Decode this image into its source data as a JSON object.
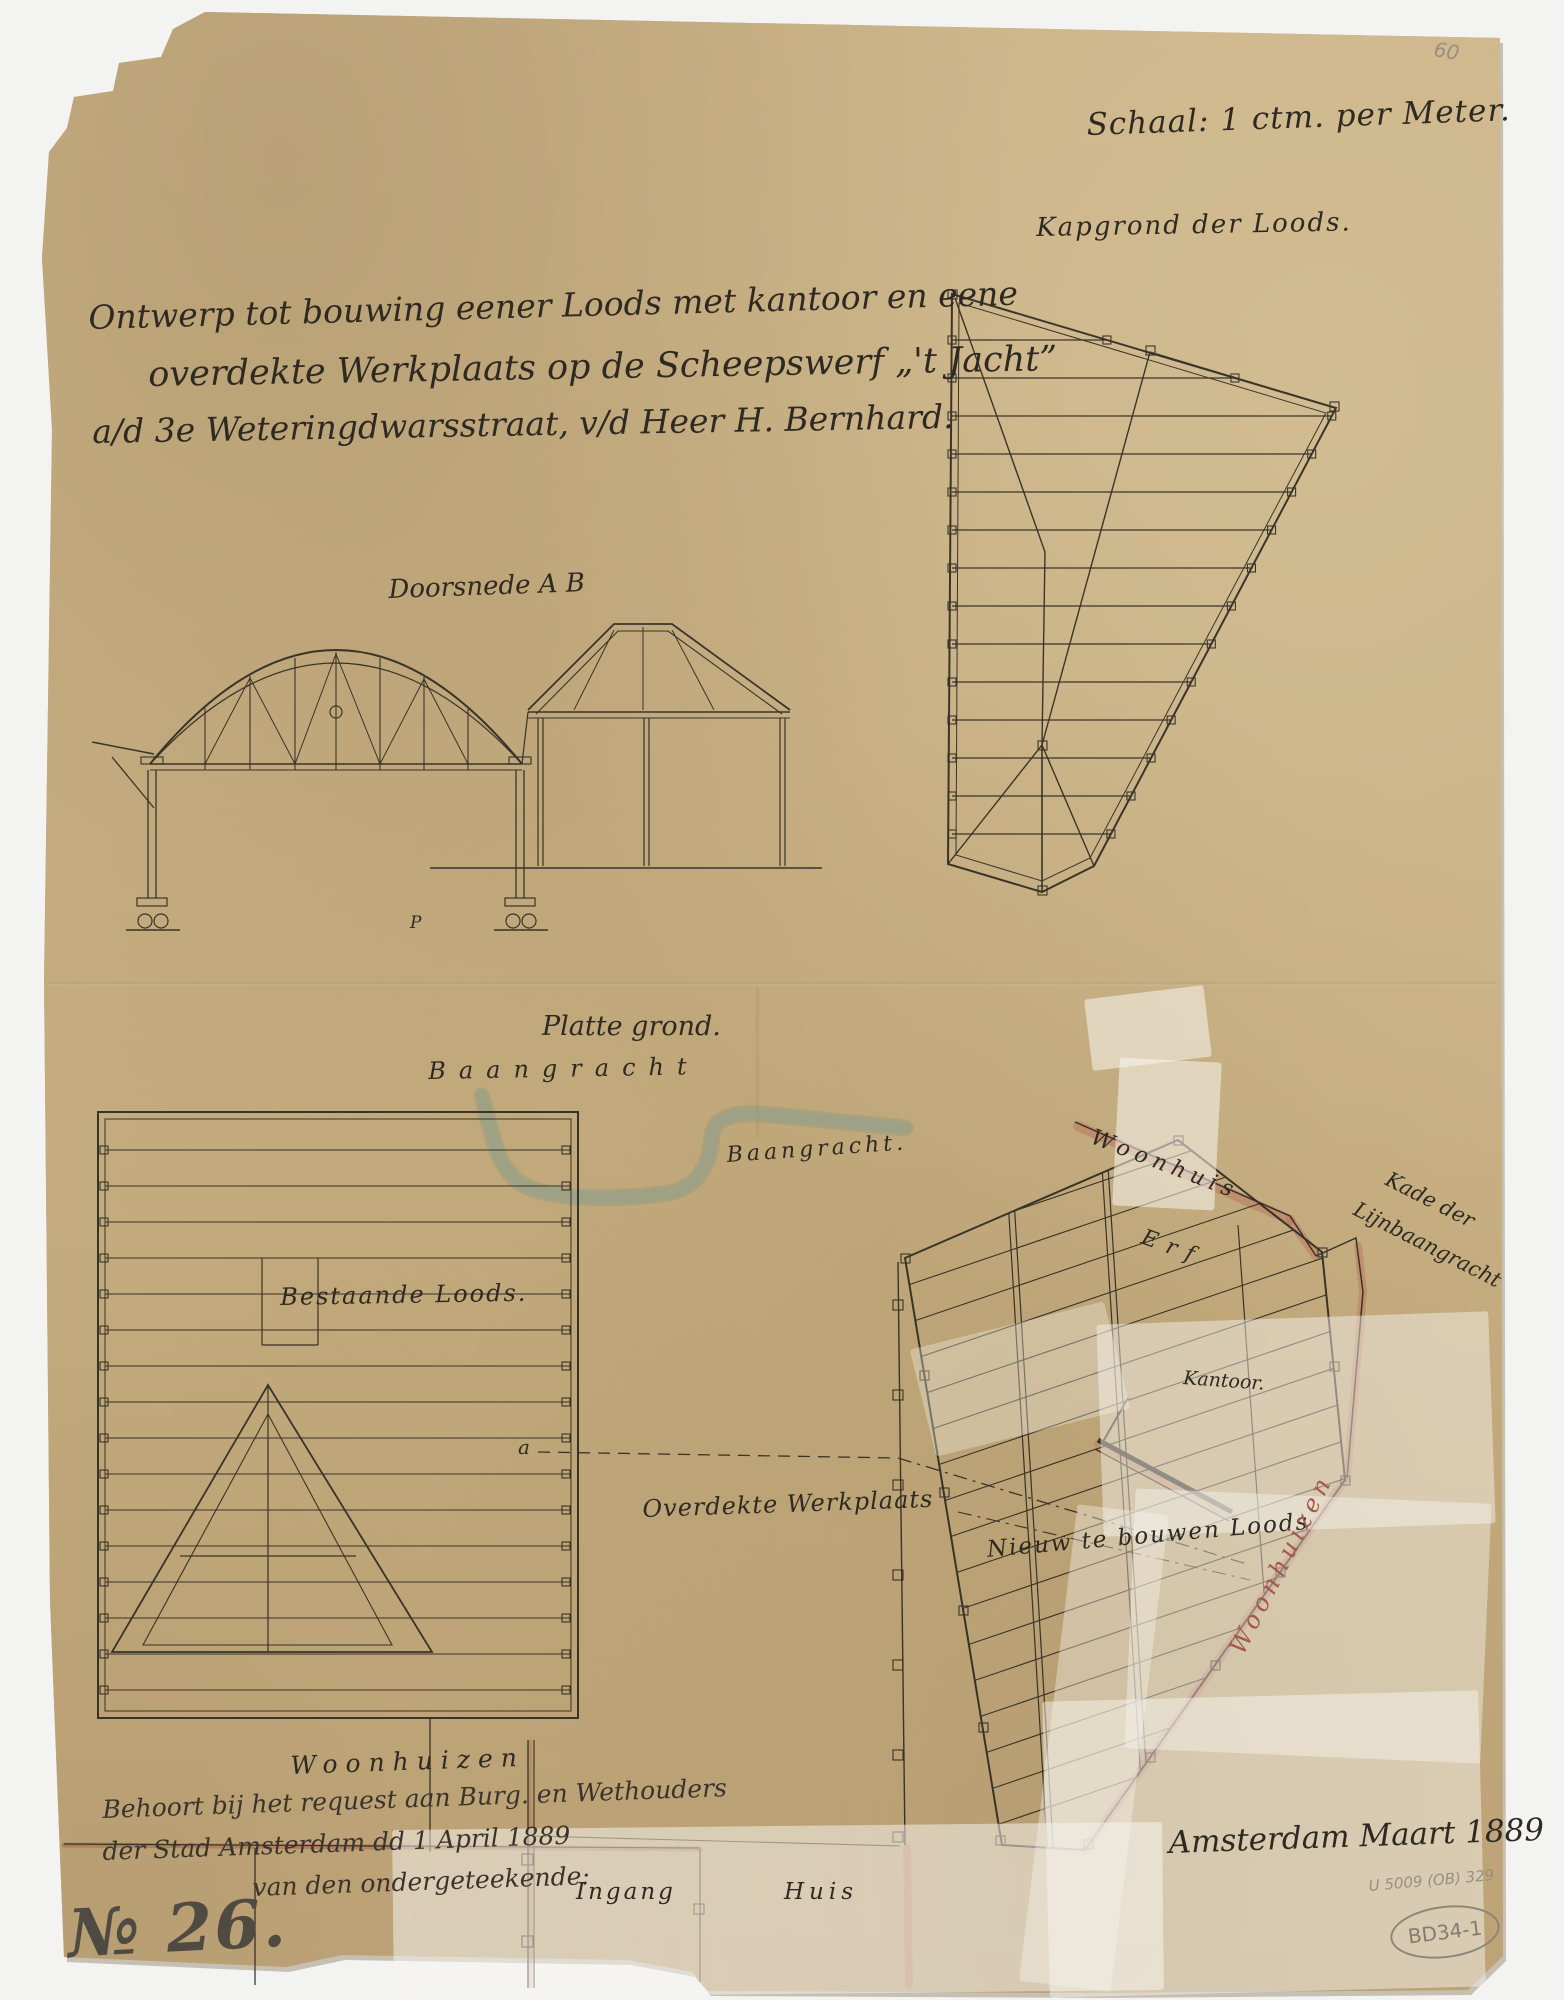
{
  "document": {
    "scale_note": "Schaal: 1 ctm. per Meter.",
    "corner_mark": "60",
    "title_lines": [
      "Ontwerp tot bouwing eener Loods met kantoor en eene",
      "overdekte Werkplaats op de Scheepswerf „'t Jacht”",
      "a/d 3e Weteringdwarsstraat, v/d Heer  H.  Bernhard."
    ],
    "roof_plan": {
      "label": "Kapgrond der Loods."
    },
    "section": {
      "label": "Doorsnede A B",
      "point_mark": "P"
    },
    "site_plan": {
      "label": "Platte grond.",
      "street": "Baangracht",
      "canal": "Baangracht.",
      "existing_shed": "Bestaande Loods.",
      "covered_workshop": "Overdekte Werkplaats",
      "house": "Woonhuis",
      "yard": "Erf",
      "quay_line1": "Kade der",
      "quay_line2": "Lijnbaangracht",
      "office": "Kantoor.",
      "new_shed": "Nieuw te bouwen Loods",
      "houses_right": "Woonhuizen",
      "houses_bottom": "Woonhuizen",
      "entrance": "Ingang",
      "house_small": "Huis",
      "section_mark": "a"
    },
    "annotation_lines": [
      "Behoort bij het request aan Burg. en Wethouders",
      "der Stad Amsterdam dd 1 April 1889",
      "van den ondergeteekende:"
    ],
    "sheet_number": "№ 26.",
    "date_note": "Amsterdam Maart 1889",
    "archive": {
      "pencil_code": "U 5009 (OB) 329",
      "stamp": "BD34-1"
    }
  },
  "colors": {
    "paper": "#c9b184",
    "ink": "#2e2a22",
    "pencil": "#968f82",
    "red_wash": "#b96a57",
    "canal": "#8fa191"
  }
}
